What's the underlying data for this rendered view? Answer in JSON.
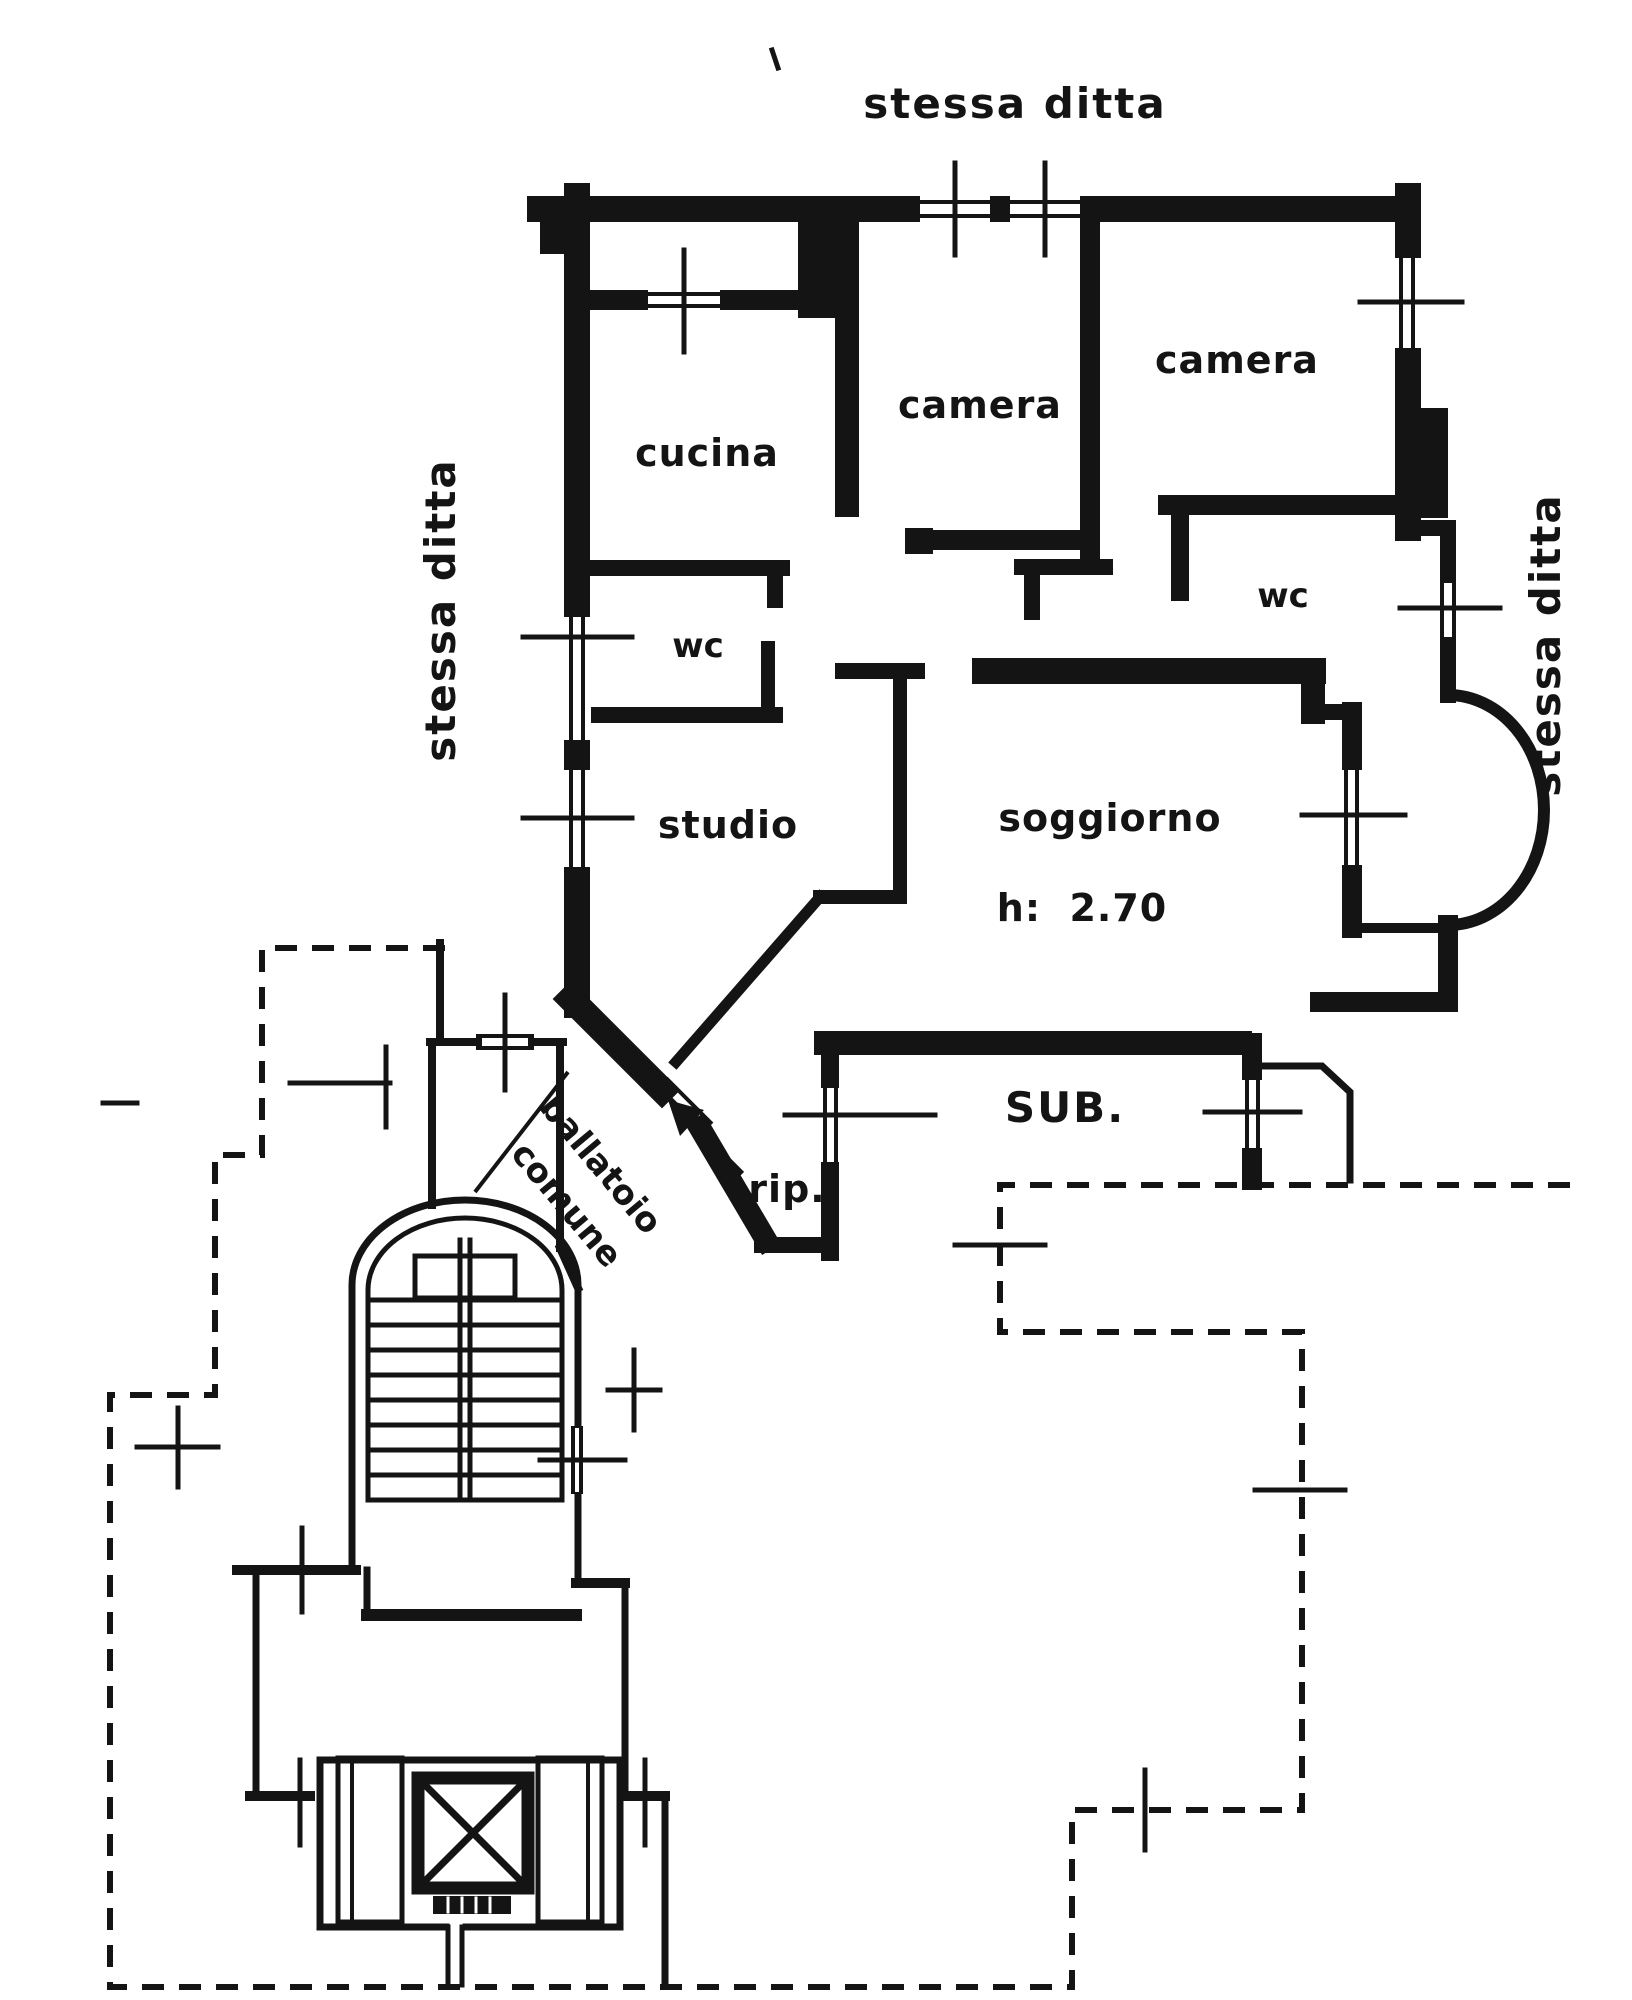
{
  "document": {
    "type": "floor-plan-scan",
    "language": "it"
  },
  "colors": {
    "ink": "#141414",
    "paper": "#ffffff"
  },
  "labels": {
    "stessa_ditta_top": "stessa ditta",
    "stessa_ditta_left": "stessa ditta",
    "stessa_ditta_right": "stessa ditta",
    "cucina": "cucina",
    "camera_top": "camera",
    "camera_right": "camera",
    "wc_left": "wc",
    "wc_right": "wc",
    "studio": "studio",
    "soggiorno": "soggiorno",
    "soggiorno_height": "h:  2.70",
    "sub": "SUB.",
    "rip": "rip.",
    "ballatoio_line1": "ballatoio",
    "ballatoio_line2": "comune"
  }
}
